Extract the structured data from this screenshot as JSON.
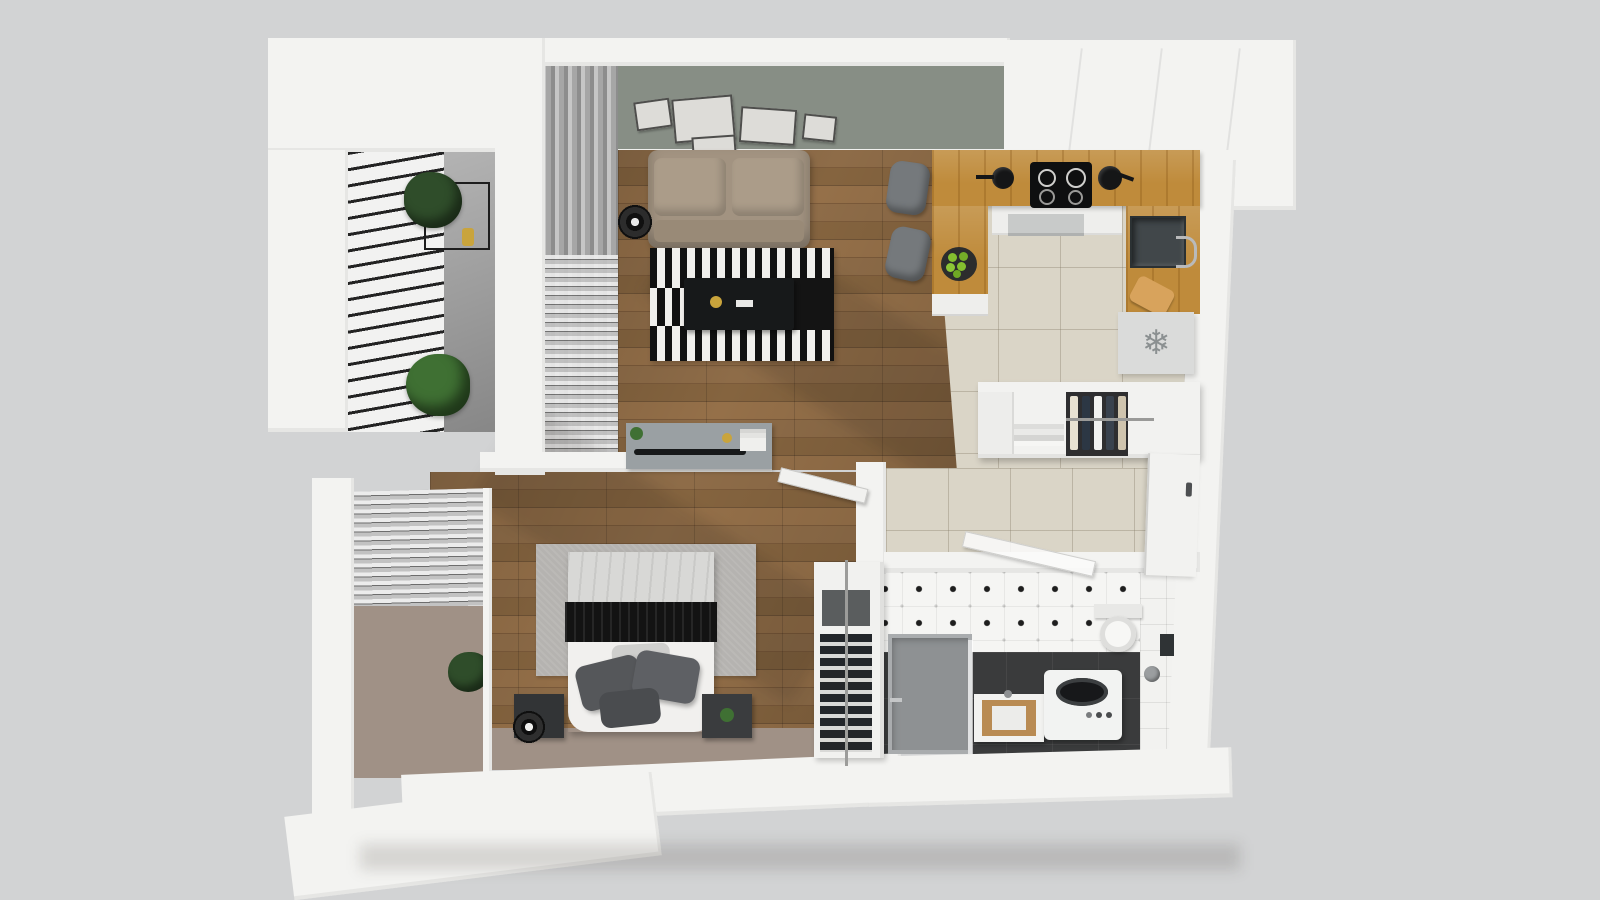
{
  "scene": {
    "type": "3d-apartment-floor-plan-top-view",
    "background": "#d2d3d4"
  },
  "colors": {
    "bg": "#d2d3d4",
    "wall": "#f3f3f1",
    "wallShade": "#e3e3e1",
    "olive": "#878e85",
    "wood": "#8a6845",
    "tile": "#dad5c7",
    "counter": "#bf8b3b",
    "concrete": "#9d9d9d",
    "taupe": "#a09186",
    "rug": "#b5b3b0",
    "sofa": "#a29381",
    "stool": "#75797c",
    "charcoal": "#3a3b3c",
    "steel": "#41474a",
    "fridge": "#dadbda",
    "snow": "#8b9091",
    "green": "#2f4d2a",
    "greenLight": "#3f7033",
    "apple": "#84c02f",
    "gold": "#c9a43c",
    "dark": "#17191a",
    "graySurface": "#9aa0a3"
  },
  "icons": {
    "snowflake": "❄"
  },
  "rooms": {
    "balcony": "balcony",
    "living": "living-room",
    "kitchen": "kitchen",
    "hallway": "entry-hallway",
    "bedroom": "bedroom",
    "bathroom": "bathroom"
  }
}
